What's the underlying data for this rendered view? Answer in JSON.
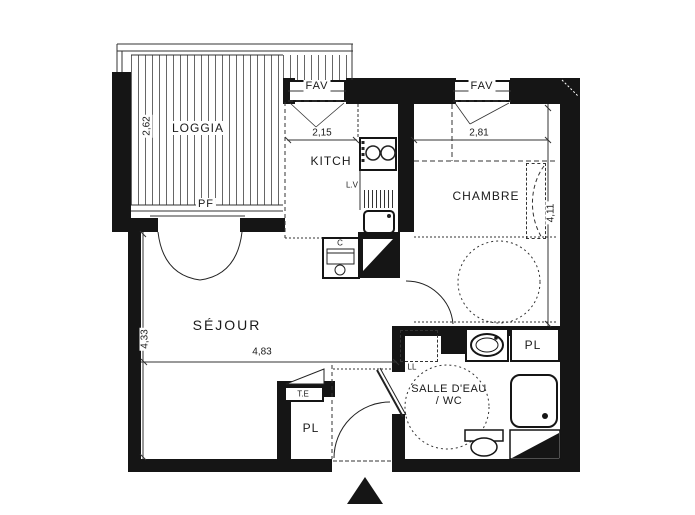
{
  "plan": {
    "colors": {
      "wall": "#151515",
      "line": "#333333",
      "background": "#ffffff"
    },
    "rooms": {
      "loggia": {
        "label": "LOGGIA",
        "depth": "2,62",
        "door": "PF"
      },
      "kitchen": {
        "label": "KITCH",
        "width": "2,15",
        "dishwasher": "L.V",
        "window": "FAV"
      },
      "bedroom": {
        "label": "CHAMBRE",
        "width": "2,81",
        "length": "4,11",
        "window": "FAV"
      },
      "living": {
        "label": "SÉJOUR",
        "length": "4,33",
        "width": "4,83",
        "water_heater": "C",
        "electrical_panel": "T.E",
        "closet": "PL"
      },
      "bathroom": {
        "label_line1": "SALLE D'EAU",
        "label_line2": "/ WC",
        "washing_machine": "LL",
        "closet": "PL"
      }
    }
  }
}
